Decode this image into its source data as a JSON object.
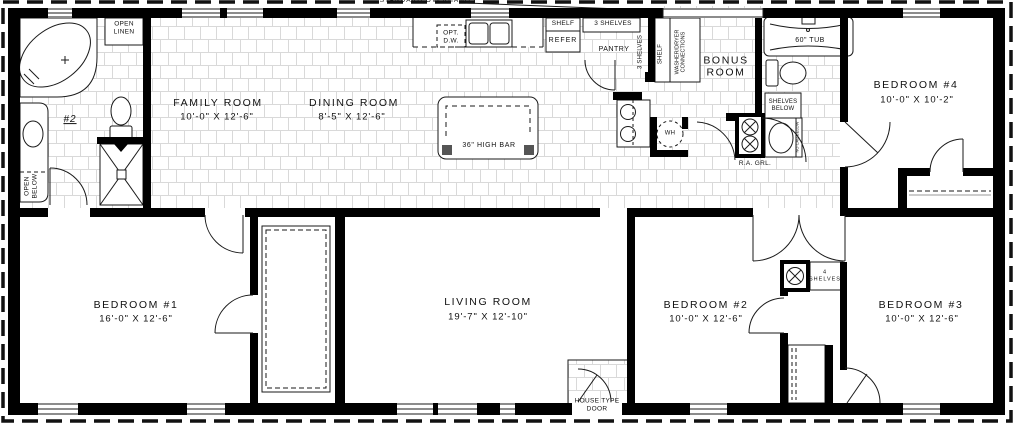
{
  "plan": {
    "rooms": {
      "family_room": {
        "name": "FAMILY ROOM",
        "dims": "10'-0\" X 12'-6\""
      },
      "dining_room": {
        "name": "DINING ROOM",
        "dims": "8'-5\" X 12'-6\""
      },
      "bonus_room": {
        "name": "BONUS\nROOM"
      },
      "bedroom_4": {
        "name": "BEDROOM #4",
        "dims": "10'-0\" X 10'-2\""
      },
      "bedroom_1": {
        "name": "BEDROOM #1",
        "dims": "16'-0\" X 12'-6\""
      },
      "living_room": {
        "name": "LIVING ROOM",
        "dims": "19'-7\" X 12'-10\""
      },
      "bedroom_2": {
        "name": "BEDROOM #2",
        "dims": "10'-0\" X 12'-6\""
      },
      "bedroom_3": {
        "name": "BEDROOM #3",
        "dims": "10'-0\" X 12'-6\""
      }
    },
    "labels": {
      "standard_overhangs": "STANDARD OVERHANGS",
      "open_linen": "OPEN\nLINEN",
      "bath_number": "#2",
      "open_below": "OPEN\nBELOW",
      "opt_dw": "OPT.\nD.W.",
      "shelf": "SHELF",
      "refer": "REFER",
      "three_shelves": "3 SHELVES",
      "pantry": "PANTRY",
      "three_shelves_vert": "3 SHELVES",
      "shelf_vert": "SHELF",
      "washer_dryer": "WASHER/DRYER\nCONNECTIONS",
      "wh": "WH",
      "ra_grl": "R.A. GRL.",
      "tub": "60\" TUB",
      "shelves_below": "SHELVES\nBELOW",
      "no_cab_below": "NO CAB BELOW",
      "four_shelves": "4\nSHELVES",
      "high_bar": "36\" HIGH BAR",
      "house_type_door": "HOUSE TYPE\nDOOR"
    },
    "colors": {
      "wall": "#000000",
      "line": "#1a1a1a",
      "tile": "#d9d9d9"
    }
  }
}
